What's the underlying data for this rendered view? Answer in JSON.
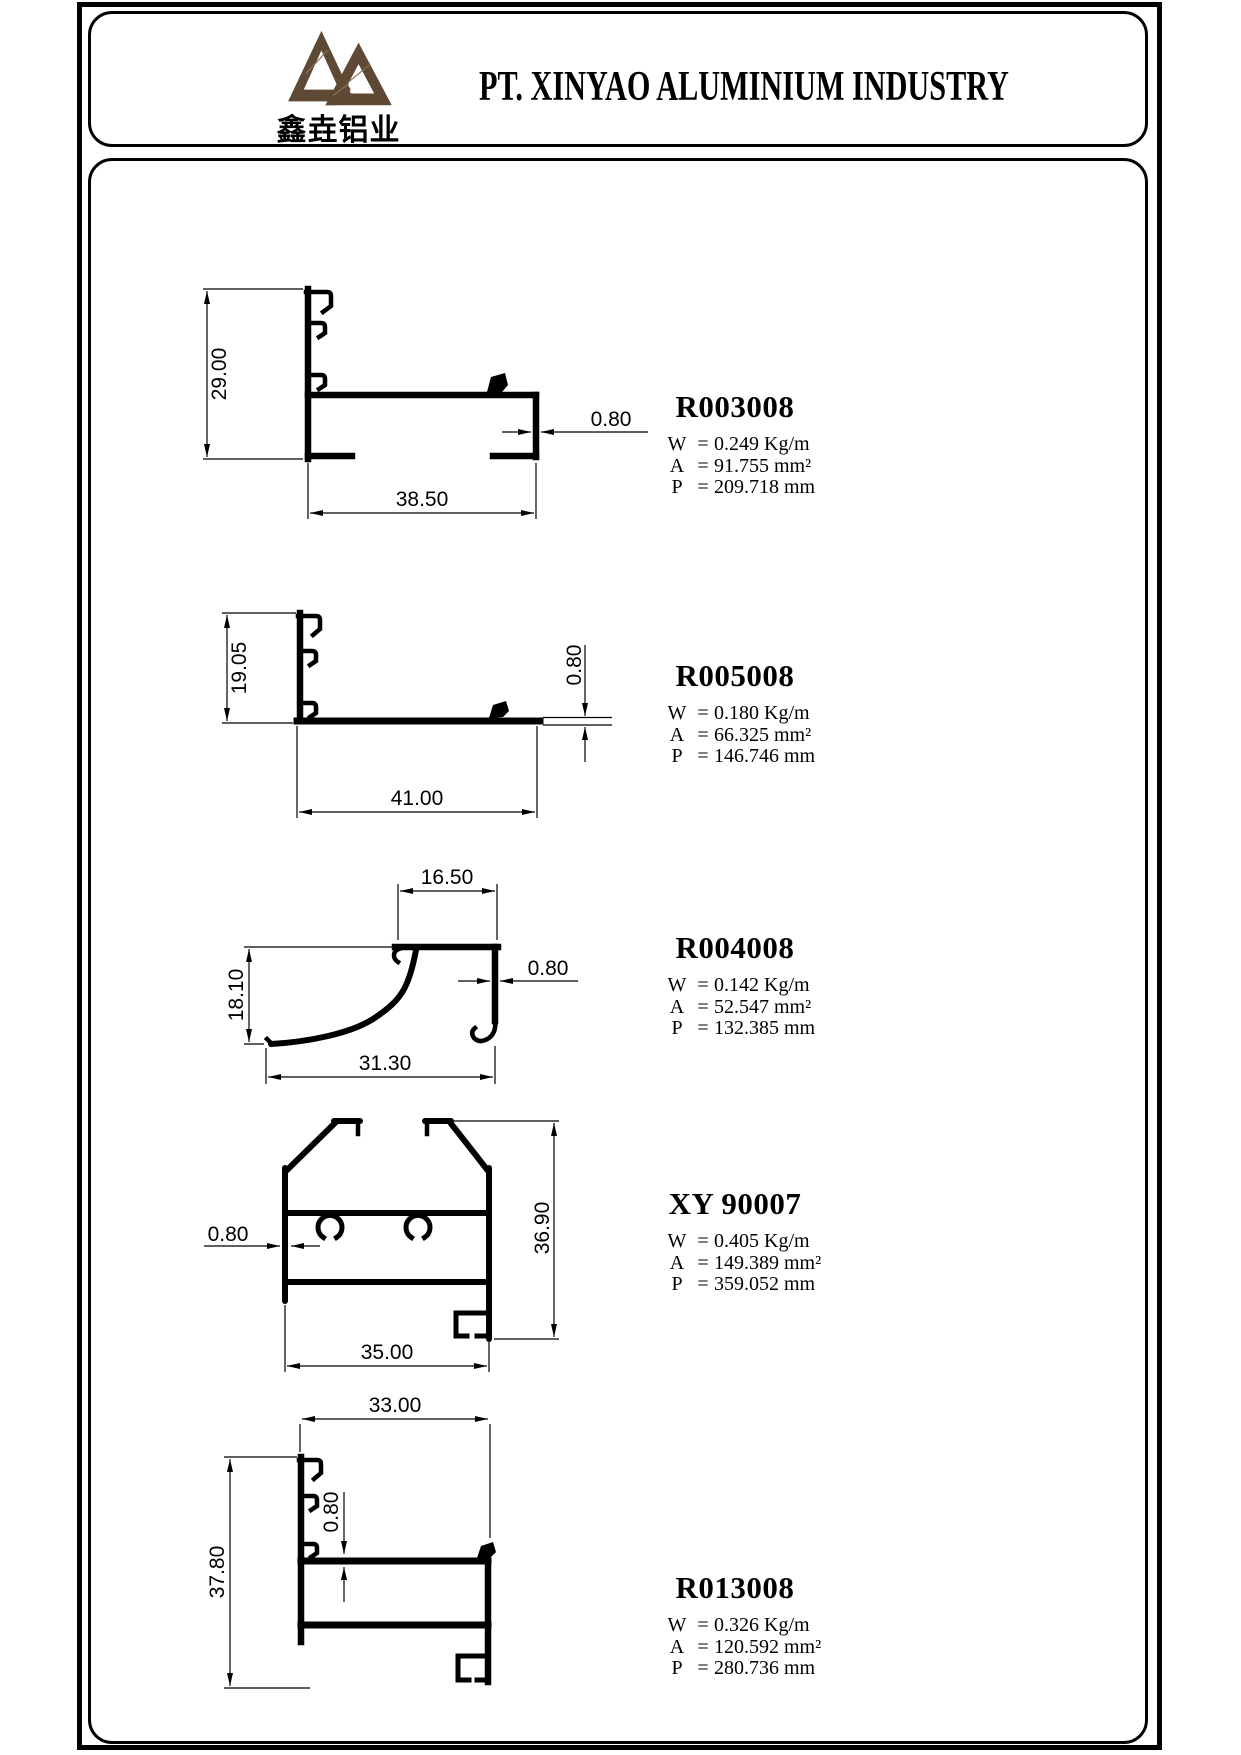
{
  "eq": "=",
  "spec_labels": {
    "w": "W",
    "a": "A",
    "p": "P"
  },
  "header": {
    "company": "PT. XINYAO ALUMINIUM INDUSTRY",
    "logo_text": "鑫垚铝业",
    "logo_color": "#5e4a34"
  },
  "profiles": [
    {
      "code": "R003008",
      "weight": "0.249 Kg/m",
      "area": "91.755 mm²",
      "perimeter": "209.718 mm",
      "dims": {
        "height": "29.00",
        "wall": "0.80",
        "width": "38.50"
      }
    },
    {
      "code": "R005008",
      "weight": "0.180 Kg/m",
      "area": "66.325 mm²",
      "perimeter": "146.746 mm",
      "dims": {
        "height": "19.05",
        "wall": "0.80",
        "width": "41.00"
      }
    },
    {
      "code": "R004008",
      "weight": "0.142 Kg/m",
      "area": "52.547 mm²",
      "perimeter": "132.385 mm",
      "dims": {
        "top_width": "16.50",
        "height": "18.10",
        "wall": "0.80",
        "width": "31.30"
      }
    },
    {
      "code": "XY 90007",
      "weight": "0.405 Kg/m",
      "area": "149.389 mm²",
      "perimeter": "359.052 mm",
      "dims": {
        "wall": "0.80",
        "height": "36.90",
        "width": "35.00"
      }
    },
    {
      "code": "R013008",
      "weight": "0.326 Kg/m",
      "area": "120.592 mm²",
      "perimeter": "280.736 mm",
      "dims": {
        "width": "33.00",
        "wall": "0.80",
        "height": "37.80"
      }
    }
  ]
}
